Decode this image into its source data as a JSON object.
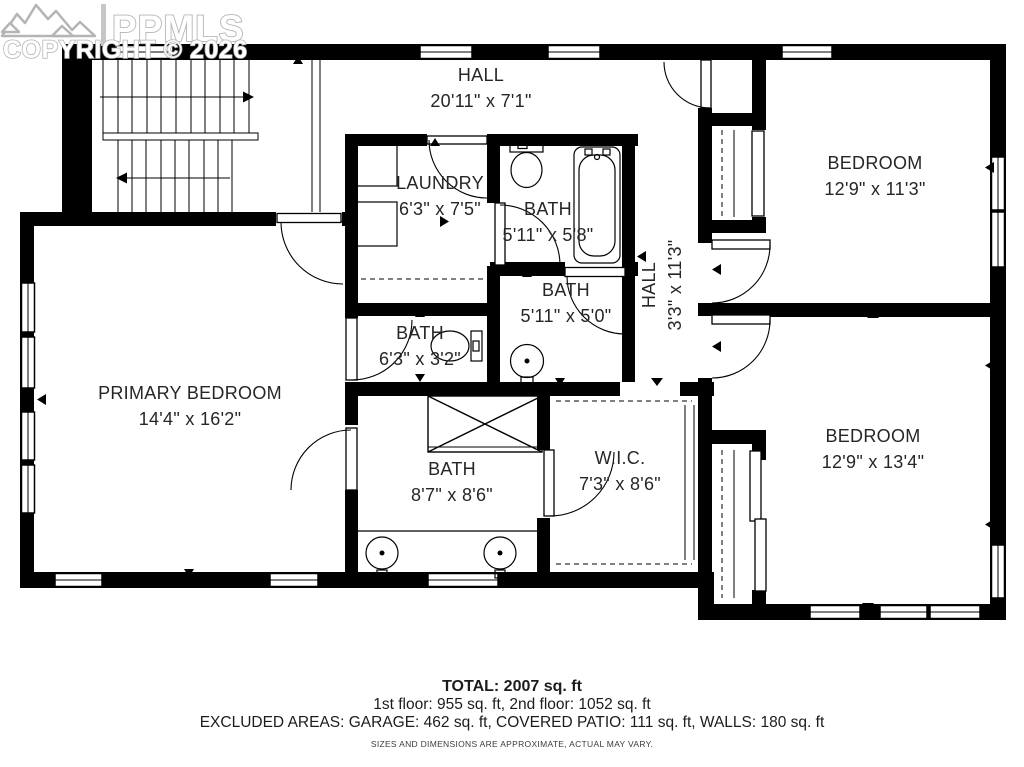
{
  "watermark": {
    "logo_text": "PPMLS",
    "copyright": "COPYRIGHT © 2026"
  },
  "rooms": [
    {
      "id": "hall-upper",
      "name": "HALL",
      "dims": "20'11\" x 7'1\""
    },
    {
      "id": "laundry",
      "name": "LAUNDRY",
      "dims": "6'3\" x 7'5\""
    },
    {
      "id": "bath-top",
      "name": "BATH",
      "dims": "5'11\" x 5'8\""
    },
    {
      "id": "bath-middle",
      "name": "BATH",
      "dims": "5'11\" x 5'0\""
    },
    {
      "id": "hall-vertical",
      "name": "HALL",
      "dims": "3'3\" x 11'3\""
    },
    {
      "id": "bedroom-top",
      "name": "BEDROOM",
      "dims": "12'9\" x 11'3\""
    },
    {
      "id": "bath-small",
      "name": "BATH",
      "dims": "6'3\" x 3'2\""
    },
    {
      "id": "primary-bedroom",
      "name": "PRIMARY BEDROOM",
      "dims": "14'4\" x 16'2\""
    },
    {
      "id": "bath-primary",
      "name": "BATH",
      "dims": "8'7\" x 8'6\""
    },
    {
      "id": "wic",
      "name": "W.I.C.",
      "dims": "7'3\" x 8'6\""
    },
    {
      "id": "bedroom-bottom",
      "name": "BEDROOM",
      "dims": "12'9\" x 13'4\""
    }
  ],
  "summary": {
    "total": "TOTAL: 2007 sq. ft",
    "floors": "1st floor: 955 sq. ft, 2nd floor: 1052 sq. ft",
    "excluded": "EXCLUDED AREAS: GARAGE: 462 sq. ft, COVERED PATIO: 111 sq. ft, WALLS: 180 sq. ft",
    "disclaimer": "SIZES AND DIMENSIONS ARE APPROXIMATE, ACTUAL MAY VARY."
  },
  "colors": {
    "wall": "#000000",
    "background": "#ffffff",
    "watermark": "#b5b5b5"
  }
}
